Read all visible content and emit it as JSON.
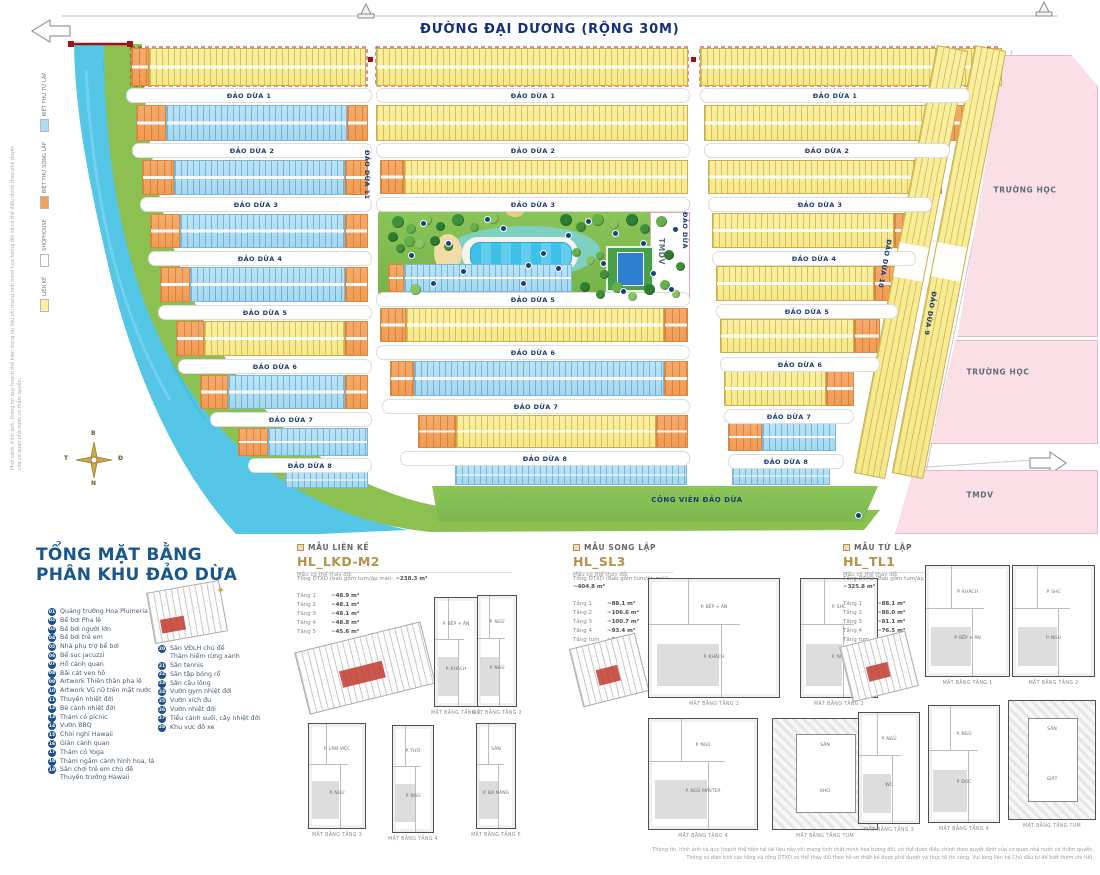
{
  "colors": {
    "accent_blue": "#19588a",
    "gold": "#b5924c",
    "lot_yellow": "#faf0a2",
    "lot_orange": "#f2a05e",
    "lot_blue": "#aedcf0",
    "school_pink": "#fbdfe6",
    "park_green": "#7cb84f",
    "water": "#52c5e6",
    "boundary_red": "#9b1313"
  },
  "map": {
    "road_title": "ĐƯỜNG ĐẠI DƯƠNG (RỘNG 30M)",
    "park_label": "CÔNG VIÊN ĐẢO DỪA",
    "compass": {
      "n": "B",
      "e": "Đ",
      "s": "N",
      "w": "T"
    },
    "legend": [
      {
        "swatch": "#faf0a2",
        "label": "LIÊN KẾ"
      },
      {
        "swatch": "#ffffff",
        "label": "SHOPHOUSE"
      },
      {
        "swatch": "#f2a05e",
        "label": "BIỆT THỰ SONG LẬP"
      },
      {
        "swatch": "#aedcf0",
        "label": "BIỆT THỰ TỨ LẬP"
      }
    ],
    "street_labels": [
      {
        "label": "ĐẢO DỪA 1",
        "x": 126,
        "y": 88,
        "w": 244
      },
      {
        "label": "ĐẢO DỪA 2",
        "x": 132,
        "y": 143,
        "w": 238
      },
      {
        "label": "ĐẢO DỪA 3",
        "x": 140,
        "y": 197,
        "w": 230
      },
      {
        "label": "ĐẢO DỪA 4",
        "x": 148,
        "y": 251,
        "w": 222
      },
      {
        "label": "ĐẢO DỪA 5",
        "x": 158,
        "y": 305,
        "w": 212
      },
      {
        "label": "ĐẢO DỪA 6",
        "x": 178,
        "y": 359,
        "w": 192
      },
      {
        "label": "ĐẢO DỪA 7",
        "x": 210,
        "y": 412,
        "w": 160
      },
      {
        "label": "ĐẢO DỪA 8",
        "x": 248,
        "y": 458,
        "w": 122
      },
      {
        "label": "ĐẢO DỪA 1",
        "x": 376,
        "y": 88,
        "w": 312
      },
      {
        "label": "ĐẢO DỪA 2",
        "x": 376,
        "y": 143,
        "w": 312
      },
      {
        "label": "ĐẢO DỪA 3",
        "x": 376,
        "y": 197,
        "w": 312
      },
      {
        "label": "ĐẢO DỪA 5",
        "x": 376,
        "y": 292,
        "w": 312
      },
      {
        "label": "ĐẢO DỪA 6",
        "x": 376,
        "y": 345,
        "w": 312
      },
      {
        "label": "ĐẢO DỪA 7",
        "x": 382,
        "y": 399,
        "w": 306
      },
      {
        "label": "ĐẢO DỪA 8",
        "x": 400,
        "y": 451,
        "w": 288
      },
      {
        "label": "ĐẢO DỪA 1",
        "x": 700,
        "y": 88,
        "w": 268
      },
      {
        "label": "ĐẢO DỪA 2",
        "x": 704,
        "y": 143,
        "w": 244
      },
      {
        "label": "ĐẢO DỪA 3",
        "x": 708,
        "y": 197,
        "w": 222
      },
      {
        "label": "ĐẢO DỪA 4",
        "x": 712,
        "y": 251,
        "w": 202
      },
      {
        "label": "ĐẢO DỪA 5",
        "x": 716,
        "y": 304,
        "w": 180
      },
      {
        "label": "ĐẢO DỪA 6",
        "x": 720,
        "y": 357,
        "w": 158
      },
      {
        "label": "ĐẢO DỪA 7",
        "x": 724,
        "y": 409,
        "w": 128
      },
      {
        "label": "ĐẢO DỪA 8",
        "x": 728,
        "y": 454,
        "w": 114
      },
      {
        "label": "ĐẢO DỪA 11",
        "x": 371,
        "y": 150,
        "rotate": 90
      },
      {
        "label": "ĐẢO DỪA",
        "x": 689,
        "y": 212,
        "rotate": 90
      },
      {
        "label": "ĐẢO DỪA 10",
        "x": 893,
        "y": 240,
        "rotate": 100
      },
      {
        "label": "ĐẢO DỪA 9",
        "x": 938,
        "y": 292,
        "rotate": 100
      }
    ],
    "area_labels": [
      {
        "label": "TRƯỜNG HỌC",
        "x": 1025,
        "y": 190
      },
      {
        "label": "TRƯỜNG HỌC",
        "x": 998,
        "y": 372
      },
      {
        "label": "TMDV",
        "x": 980,
        "y": 495
      },
      {
        "label": "TMDV",
        "x": 666,
        "y": 238,
        "rotate": 90
      },
      {
        "label": "TMDV",
        "x": 0,
        "y": 0,
        "hidden": true
      }
    ],
    "side_note": "Phối cảnh, hình ảnh, thông tin quy hoạch thể hiện trong tài liệu chỉ mang tính minh họa tương đối và có thể điều chỉnh theo phê duyệt của cơ quan nhà nước có thẩm quyền."
  },
  "overview": {
    "title_lines": [
      "TỔNG MẶT BẰNG",
      "PHÂN KHU ĐẢO DỪA"
    ],
    "items": [
      {
        "num": "01",
        "label": "Quảng trường Hoa Plumeria"
      },
      {
        "num": "02",
        "label": "Bể bơi Pha lê"
      },
      {
        "num": "03",
        "label": "Bể bơi người lớn"
      },
      {
        "num": "04",
        "label": "Bể bơi trẻ em"
      },
      {
        "num": "05",
        "label": "Nhà phụ trợ bể bơi"
      },
      {
        "num": "06",
        "label": "Bể sục jacuzzi"
      },
      {
        "num": "07",
        "label": "Hồ cảnh quan"
      },
      {
        "num": "08",
        "label": "Bãi cát ven hồ"
      },
      {
        "num": "09",
        "label": "Artwork Thiên thần pha lê"
      },
      {
        "num": "10",
        "label": "Artwork Vũ nữ trên mặt nước"
      },
      {
        "num": "11",
        "label": "Thuyền nhiệt đới"
      },
      {
        "num": "12",
        "label": "Bè cảnh nhiệt đới"
      },
      {
        "num": "13",
        "label": "Thảm cỏ picnic"
      },
      {
        "num": "14",
        "label": "Vườn BBQ"
      },
      {
        "num": "15",
        "label": "Chòi nghỉ Hawaii"
      },
      {
        "num": "16",
        "label": "Giàn cảnh quan"
      },
      {
        "num": "17",
        "label": "Thảm cỏ Yoga"
      },
      {
        "num": "18",
        "label": "Thảm ngắm cảnh hình hoa, lá"
      },
      {
        "num": "19",
        "label": "Sân chơi trẻ em chủ đề",
        "label2": "Thuyền trưởng Hawaii"
      },
      {
        "num": "20",
        "label": "Sân VĐLH chủ đề",
        "label2": "Thám hiểm rừng xanh"
      },
      {
        "num": "21",
        "label": "Sân tennis"
      },
      {
        "num": "22",
        "label": "Sân tập bóng rổ"
      },
      {
        "num": "23",
        "label": "Sân cầu lông"
      },
      {
        "num": "24",
        "label": "Vườn gym nhiệt đới"
      },
      {
        "num": "25",
        "label": "Vườn xích đu"
      },
      {
        "num": "26",
        "label": "Vườn nhiệt đới"
      },
      {
        "num": "27",
        "label": "Tiểu cảnh suối, cây nhiệt đới"
      },
      {
        "num": "28",
        "label": "Khu vực đỗ xe"
      }
    ]
  },
  "models": [
    {
      "category": "MẪU LIÊN KẾ",
      "code": "HL_LKD-M2",
      "note": "Mẫu có thể thay đổi",
      "total_label": "Tổng DTXD (bao gồm tum/áp mái):",
      "total_value": "~238.3 m²",
      "floors": [
        {
          "name": "Tầng 1",
          "value": "~48.9 m²"
        },
        {
          "name": "Tầng 2",
          "value": "~48.1 m²"
        },
        {
          "name": "Tầng 3",
          "value": "~48.1 m²"
        },
        {
          "name": "Tầng 4",
          "value": "~48.8 m²"
        },
        {
          "name": "Tầng 5",
          "value": "~45.6 m²"
        }
      ],
      "plans": [
        {
          "caption": "MẶT BẰNG TẦNG 1",
          "rooms": [
            "P. BẾP + ĂN",
            "P. KHÁCH"
          ]
        },
        {
          "caption": "MẶT BẰNG TẦNG 2",
          "rooms": [
            "P. NGỦ",
            "P. NGỦ"
          ]
        },
        {
          "caption": "MẶT BẰNG TẦNG 3",
          "rooms": [
            "P. LÀM VIỆC",
            "P. NGỦ"
          ]
        },
        {
          "caption": "MẶT BẰNG TẦNG 4",
          "rooms": [
            "P. THỜ",
            "P. NGỦ"
          ]
        },
        {
          "caption": "MẶT BẰNG TẦNG 5",
          "rooms": [
            "SÂN",
            "P. ĐA NĂNG"
          ]
        }
      ]
    },
    {
      "category": "MẪU SONG LẬP",
      "code": "HL_SL3",
      "note": "Mẫu có thể thay đổi",
      "total_label": "Tổng DTXD (Bao gồm tum/áp mái):",
      "total_value": "~404.8 m²",
      "floors": [
        {
          "name": "Tầng 1",
          "value": "~88.1 m²"
        },
        {
          "name": "Tầng 2",
          "value": "~106.6 m²"
        },
        {
          "name": "Tầng 3",
          "value": "~100.7 m²"
        },
        {
          "name": "Tầng 4",
          "value": "~93.4 m²"
        },
        {
          "name": "Tầng tum",
          "value": "~16.6 m²"
        }
      ],
      "plans": [
        {
          "caption": "MẶT BẰNG TẦNG 1",
          "rooms": [
            "P. BẾP + ĂN",
            "P. KHÁCH"
          ]
        },
        {
          "caption": "MẶT BẰNG TẦNG 2",
          "rooms": [
            "P. SHC",
            "P. NGỦ"
          ]
        },
        {
          "caption": "MẶT BẰNG TẦNG 4",
          "rooms": [
            "P. NGỦ",
            "P. NGỦ MASTER"
          ]
        },
        {
          "caption": "MẶT BẰNG TẦNG TUM",
          "rooms": [
            "SÂN",
            "KHO"
          ],
          "roof": true
        }
      ]
    },
    {
      "category": "MẪU TỨ LẬP",
      "code": "HL_TL1",
      "note": "Mẫu có thể thay đổi",
      "total_label": "Tổng DTXD (Bao gồm tum/áp mái):",
      "total_value": "~325.8 m²",
      "floors": [
        {
          "name": "Tầng 1",
          "value": "~88.1 m²"
        },
        {
          "name": "Tầng 2",
          "value": "~86.0 m²"
        },
        {
          "name": "Tầng 3",
          "value": "~81.1 m²"
        },
        {
          "name": "Tầng 4",
          "value": "~76.5 m²"
        },
        {
          "name": "Tầng tum",
          "value": "~16.1 m²"
        }
      ],
      "plans": [
        {
          "caption": "MẶT BẰNG TẦNG 1",
          "rooms": [
            "P. KHÁCH",
            "P. BẾP + ĂN"
          ]
        },
        {
          "caption": "MẶT BẰNG TẦNG 2",
          "rooms": [
            "P. SHC",
            "P. NGỦ"
          ]
        },
        {
          "caption": "MẶT BẰNG TẦNG 3",
          "rooms": [
            "P. NGỦ",
            "WC"
          ]
        },
        {
          "caption": "MẶT BẰNG TẦNG 4",
          "rooms": [
            "P. NGỦ",
            "P. ĐỌC"
          ]
        },
        {
          "caption": "MẶT BẰNG TẦNG TUM",
          "rooms": [
            "SÂN",
            "GIẶT"
          ],
          "roof": true
        }
      ]
    }
  ],
  "footer": {
    "lines": [
      "Thông tin, hình ảnh và quy hoạch thể hiện tại tài liệu này chỉ mang tính chất minh họa tương đối, có thể được điều chỉnh theo quyết định của cơ quan nhà nước có thẩm quyền.",
      "Thông số diện tích các tầng và tổng DTXD có thể thay đổi theo hồ sơ thiết kế được phê duyệt và thực tế thi công. Vui lòng liên hệ Chủ đầu tư để biết thêm chi tiết."
    ]
  }
}
